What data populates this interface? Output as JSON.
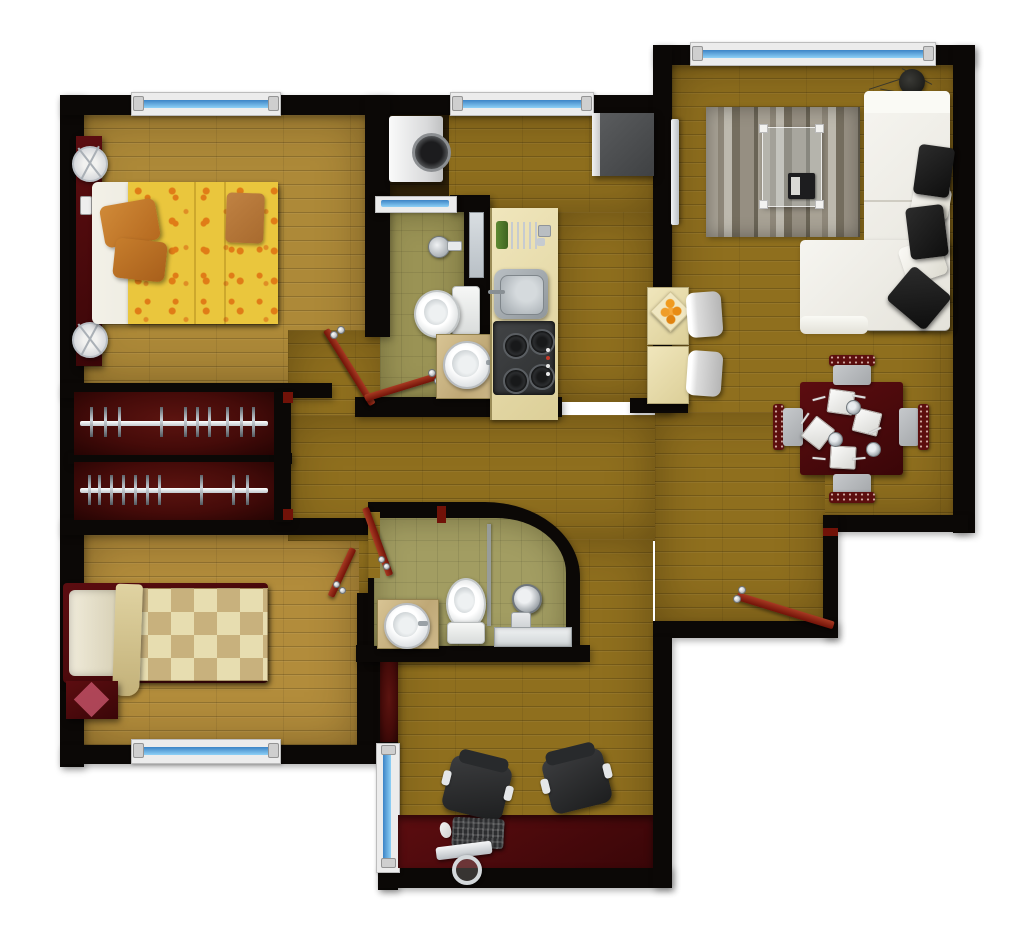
{
  "scene": {
    "title": "Apartment Floor Plan - Top-down 3D Render",
    "type": "floorplan",
    "bedrooms": 2,
    "bathrooms": 2,
    "windows": 6,
    "doors": 5
  },
  "palette": {
    "outside": "#ffffff",
    "wall": "#0b0806",
    "wood": "#8f6f1e",
    "woodLight": "#ad8938",
    "woodBed2": "#b28c3b",
    "olive": "#9a9355",
    "olive2": "#a29d62",
    "cream": "#e9ddab",
    "closetRed": "#450b09",
    "furnRed": "#3a0608",
    "doorRed": "#711208",
    "glassBlue": "#5aa2e0",
    "sofaWhite": "#f2f1ea",
    "cushionBlack": "#0e0e0e",
    "bedYellow": "#eac63d",
    "patternOrange": "#e07c17",
    "checkerLight": "#e7ddb0",
    "checkerDark": "#c8b17d"
  },
  "rooms": [
    {
      "id": "master-bedroom",
      "label": "Master Bedroom",
      "furniture": [
        "double-bed-yellow-floral",
        "headboard",
        "bedside-lamp",
        "bedside-lamp",
        "phone",
        "folded-blanket",
        "orange-pillows",
        "window"
      ]
    },
    {
      "id": "closet-hall",
      "label": "Closet Hallway",
      "furniture": [
        "wardrobe-with-hangers",
        "wardrobe-with-hangers"
      ]
    },
    {
      "id": "second-bedroom",
      "label": "Second Bedroom",
      "furniture": [
        "single-bed-checkered",
        "pillow",
        "ottoman-with-diamond",
        "window",
        "door"
      ]
    },
    {
      "id": "laundry-nook",
      "label": "Laundry Nook",
      "furniture": [
        "washing-machine"
      ]
    },
    {
      "id": "bathroom-1",
      "label": "Bathroom 1",
      "furniture": [
        "toilet",
        "round-basin-vanity",
        "shower-head",
        "mirror",
        "window",
        "door"
      ]
    },
    {
      "id": "kitchen",
      "label": "Kitchen",
      "furniture": [
        "counter",
        "dish-rack",
        "sink",
        "four-burner-stove",
        "refrigerator",
        "breakfast-bar",
        "bar-stool",
        "bar-stool",
        "fruit-bowl"
      ]
    },
    {
      "id": "living-room",
      "label": "Living Room",
      "furniture": [
        "l-shaped-white-sofa",
        "black-cushions",
        "white-pillows",
        "striped-rug",
        "glass-coffee-table",
        "magazine",
        "wall-tv",
        "potted-plant",
        "window"
      ]
    },
    {
      "id": "dining-area",
      "label": "Dining Area",
      "furniture": [
        "square-dining-table",
        "dining-chair",
        "dining-chair",
        "dining-chair",
        "dining-chair",
        "place-settings",
        "glasses",
        "cutlery"
      ]
    },
    {
      "id": "bathroom-2",
      "label": "Bathroom 2",
      "furniture": [
        "toilet",
        "round-basin-vanity",
        "hand-shower",
        "glass-partition",
        "shower-tray",
        "door"
      ]
    },
    {
      "id": "office",
      "label": "Office / Study",
      "furniture": [
        "desk",
        "office-chair",
        "office-chair",
        "monitor",
        "keyboard",
        "mouse",
        "window"
      ]
    },
    {
      "id": "entry-hall",
      "label": "Entry Hall",
      "furniture": [
        "entry-door"
      ]
    }
  ]
}
